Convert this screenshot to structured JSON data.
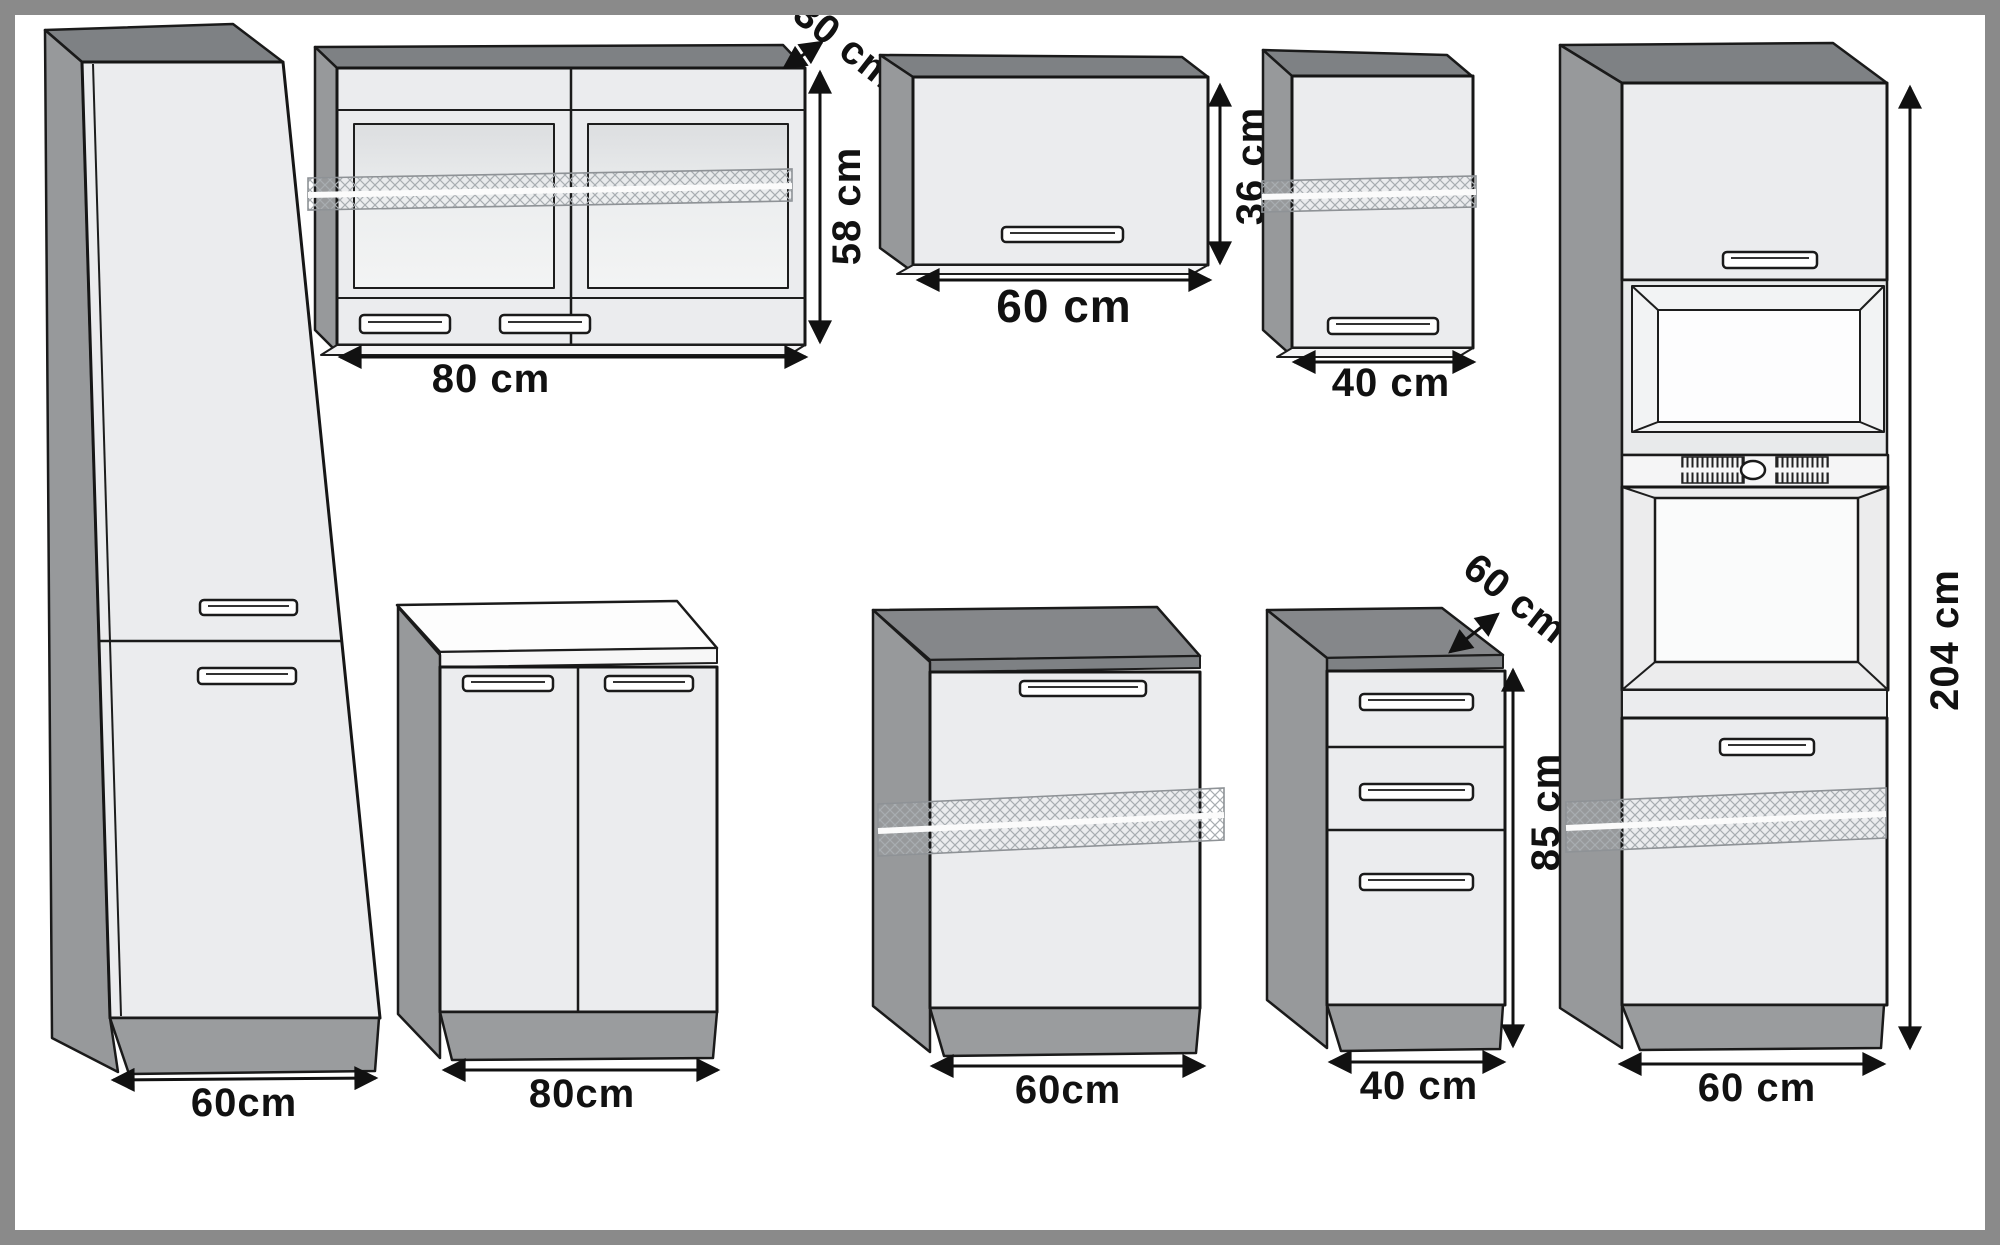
{
  "page": {
    "title": "Kitchen cabinet set dimension diagram"
  },
  "colors": {
    "frame_border": "#8a8a8a",
    "line": "#1a1a1a",
    "side_gray": "#97999b",
    "top_gray": "#7e8184",
    "front_light": "#ebecee",
    "plinth_gray": "#9a9c9e",
    "countertop_white": "#fdfdfd",
    "hatch_gray": "#a8adb1"
  },
  "cabinets": {
    "tall_left": {
      "width": "60cm"
    },
    "wall_80": {
      "width": "80 cm",
      "height": "58 cm",
      "depth": "30 cm"
    },
    "wall_60": {
      "width": "60 cm",
      "height": "36 cm"
    },
    "wall_40": {
      "width": "40 cm"
    },
    "base_80": {
      "width": "80cm"
    },
    "base_60": {
      "width": "60cm"
    },
    "drawer_40": {
      "width": "40 cm",
      "height": "85 cm",
      "depth": "60 cm"
    },
    "oven_tower": {
      "width": "60 cm",
      "height": "204 cm"
    }
  }
}
